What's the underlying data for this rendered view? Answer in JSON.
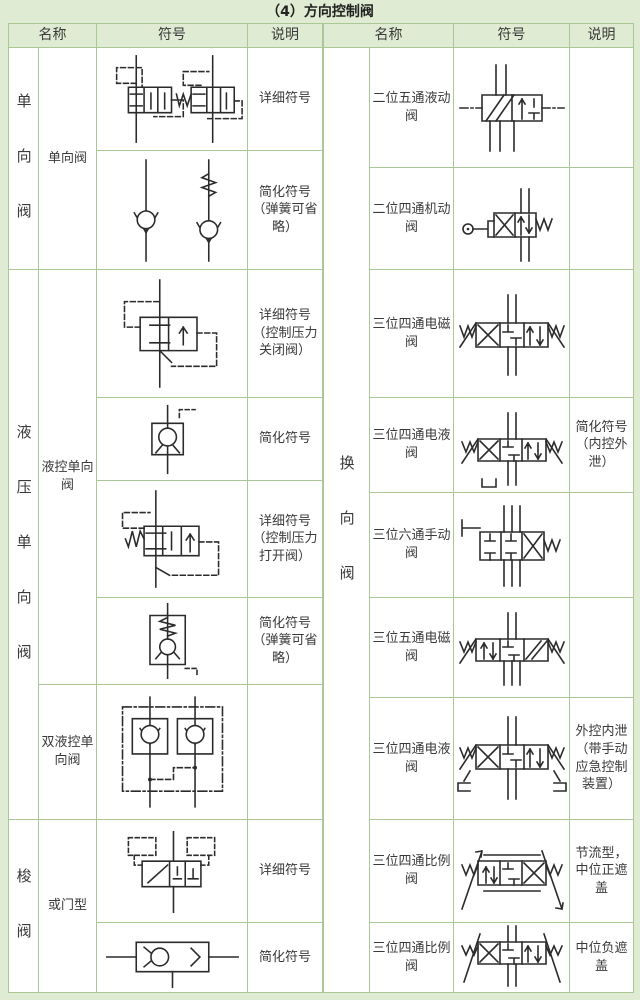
{
  "title": "（4）方向控制阀",
  "colors": {
    "band_green": "#dfebd2",
    "border_green": "#a9c896",
    "symbol_ink": "#2b2b2b"
  },
  "header": {
    "name": "名称",
    "symbol": "符号",
    "desc": "说明"
  },
  "left": {
    "groups": [
      {
        "label": "单向阀"
      },
      {
        "label": "液压单向阀"
      },
      {
        "label": "梭阀"
      }
    ],
    "subgroups": [
      {
        "label": "单向阀"
      },
      {
        "label": "液控单向阀"
      },
      {
        "label": "双液控单向阀"
      },
      {
        "label": "或门型"
      }
    ],
    "rows": [
      {
        "desc": "详细符号",
        "symbol": "check-valve-detailed"
      },
      {
        "desc": "简化符号（弹簧可省略）",
        "symbol": "check-valve-simplified"
      },
      {
        "desc": "详细符号（控制压力关闭阀）",
        "symbol": "pilot-check-close-detailed"
      },
      {
        "desc": "简化符号",
        "symbol": "pilot-check-simplified"
      },
      {
        "desc": "详细符号（控制压力打开阀）",
        "symbol": "pilot-check-open-detailed"
      },
      {
        "desc": "简化符号（弹簧可省略）",
        "symbol": "pilot-check-spring-simplified"
      },
      {
        "desc": "",
        "symbol": "double-pilot-check"
      },
      {
        "desc": "详细符号",
        "symbol": "shuttle-detailed"
      },
      {
        "desc": "简化符号",
        "symbol": "shuttle-simplified"
      }
    ]
  },
  "right": {
    "group_label": "换向阀",
    "rows": [
      {
        "name": "二位五通液动阀",
        "desc": "",
        "symbol": "two-pos-five-way-hydraulic"
      },
      {
        "name": "二位四通机动阀",
        "desc": "",
        "symbol": "two-pos-four-way-mechanical"
      },
      {
        "name": "三位四通电磁阀",
        "desc": "",
        "symbol": "three-pos-four-way-solenoid"
      },
      {
        "name": "三位四通电液阀",
        "desc": "简化符号（内控外泄）",
        "symbol": "three-pos-four-way-eh-simplified"
      },
      {
        "name": "三位六通手动阀",
        "desc": "",
        "symbol": "three-pos-six-way-manual"
      },
      {
        "name": "三位五通电磁阀",
        "desc": "",
        "symbol": "three-pos-five-way-solenoid"
      },
      {
        "name": "三位四通电液阀",
        "desc": "外控内泄（带手动应急控制装置）",
        "symbol": "three-pos-four-way-eh-manual"
      },
      {
        "name": "三位四通比例阀",
        "desc": "节流型，中位正遮盖",
        "symbol": "three-pos-four-way-proportional-throttle"
      },
      {
        "name": "三位四通比例阀",
        "desc": "中位负遮盖",
        "symbol": "three-pos-four-way-proportional-negative"
      }
    ]
  }
}
